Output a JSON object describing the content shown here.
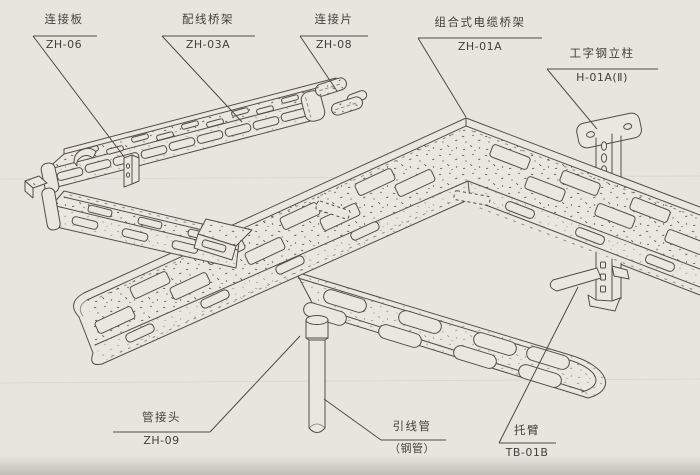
{
  "diagram_title": "组合式电缆桥架安装示意图",
  "colors": {
    "paper": "#e8e5df",
    "shape_fill": "#eae7e1",
    "line": "#524e47",
    "text": "#44403a"
  },
  "labels": {
    "connection_plate": {
      "name": "连接板",
      "code": "ZH-06"
    },
    "wiring_tray": {
      "name": "配线桥架",
      "code": "ZH-03A"
    },
    "connection_piece": {
      "name": "连接片",
      "code": "ZH-08"
    },
    "cable_tray": {
      "name": "组合式电缆桥架",
      "code": "ZH-01A"
    },
    "steel_column": {
      "name": "工字钢立柱",
      "code": "H-01A(Ⅱ)"
    },
    "pipe_joint": {
      "name": "管接头",
      "code": "ZH-09"
    },
    "lead_pipe": {
      "name": "引线管",
      "code": "（钢管）"
    },
    "support_arm": {
      "name": "托臂",
      "code": "TB-01B"
    }
  }
}
